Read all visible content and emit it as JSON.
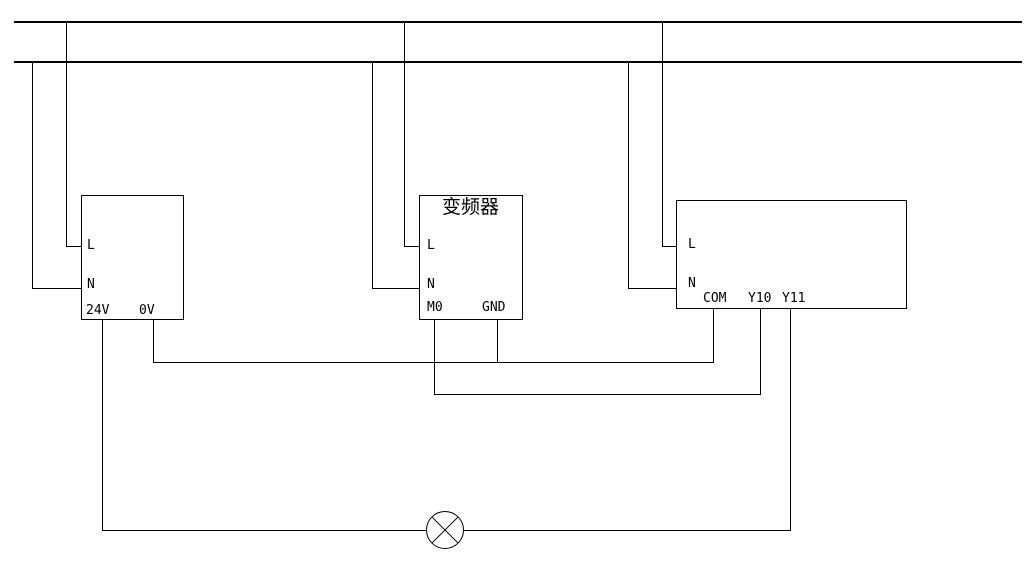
{
  "diagram": {
    "type": "wiring-schematic",
    "background_color": "#ffffff",
    "line_color": "#000000"
  },
  "power_supply_box": {
    "terminals": {
      "l": "L",
      "n": "N",
      "v24": "24V",
      "v0": "0V"
    }
  },
  "inverter_box": {
    "title": "变频器",
    "terminals": {
      "l": "L",
      "n": "N",
      "m0": "M0",
      "gnd": "GND"
    }
  },
  "plc_box": {
    "terminals": {
      "l": "L",
      "n": "N",
      "com": "COM",
      "y10": "Y10",
      "y11": "Y11"
    }
  }
}
